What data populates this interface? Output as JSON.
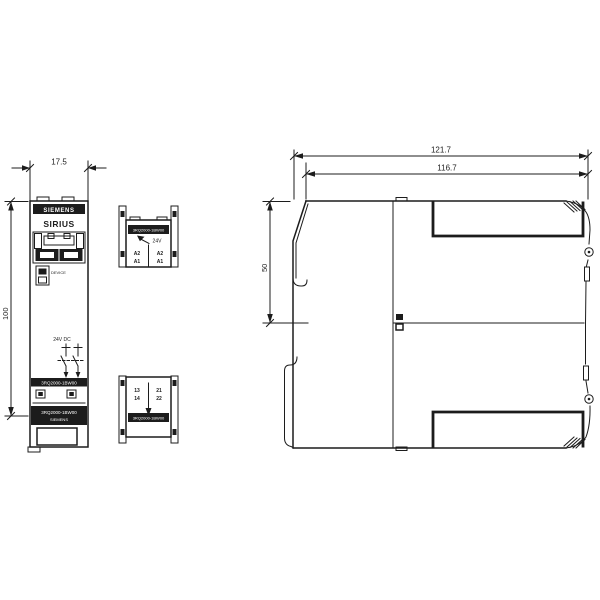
{
  "colors": {
    "line": "#1c1c1c",
    "background": "#ffffff"
  },
  "front_view": {
    "dim_width": "17.5",
    "dim_height": "100",
    "brand": "SIEMENS",
    "product_line": "SIRIUS",
    "led_label": "DEVICE",
    "voltage_label": "24V DC",
    "part_number": "3RQ2000-1BW00",
    "label_band_line1": "3RQ2000-1BW00",
    "label_band_line2": "SIEMENS"
  },
  "top_view": {
    "part_number": "3RQ2000-1BW00",
    "voltage_label": "24V",
    "terminal_left_top": "A2",
    "terminal_left_bottom": "A1",
    "terminal_right_top": "A2",
    "terminal_right_bottom": "A1"
  },
  "bottom_view": {
    "part_number": "3RQ2000-1BW00",
    "terminal_left_top": "13",
    "terminal_left_bottom": "14",
    "terminal_right_top": "21",
    "terminal_right_bottom": "22"
  },
  "side_view": {
    "dim_overall": "121.7",
    "dim_body": "116.7",
    "dim_upper": "50"
  }
}
